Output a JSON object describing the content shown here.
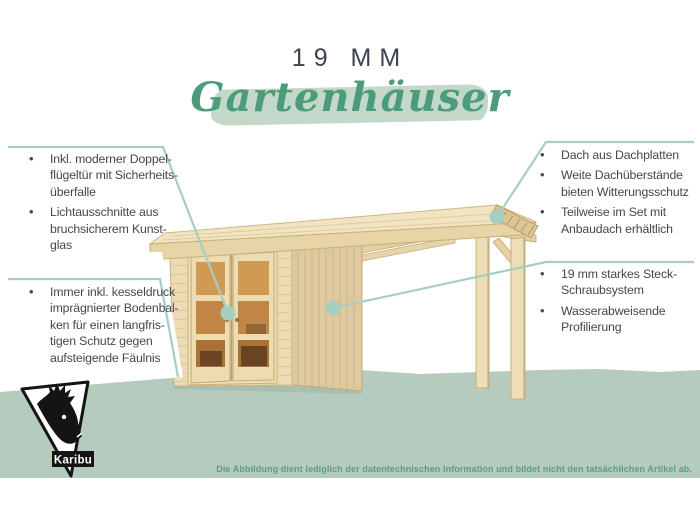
{
  "palette": {
    "accent_teal": "#a6cec1",
    "script_green": "#4c9c7c",
    "swash_green": "#c4d8ca",
    "ground_green": "#b5cbbd",
    "disclaimer_green": "#5aa07c",
    "heading_dark": "#3d4350",
    "text_dark": "#42484f",
    "wood_front": "#ecdbb3",
    "wood_side": "#dfc99e",
    "wood_roof_top": "#f2e4c0",
    "wood_fascia": "#e7d5a8",
    "wood_post": "#eedeb8",
    "wood_beam": "#e4d0a2",
    "logo_black": "#141414"
  },
  "header": {
    "size_label": "19 MM",
    "script_title": "Gartenhäuser"
  },
  "callouts": {
    "left_top": {
      "items": [
        "Inkl. moderner Doppel-\nflügeltür mit Sicherheits-\nüberfalle",
        "Lichtausschnitte aus\nbruchsicherem Kunst-\nglas"
      ]
    },
    "left_bottom": {
      "items": [
        "Immer inkl. kesseldruck\nimprägnierter Bodenbal-\nken für einen langfris-\ntigen Schutz gegen\naufsteigende Fäulnis"
      ]
    },
    "right_top": {
      "items": [
        "Dach aus Dachplatten",
        "Weite Dachüberstände\nbieten Witterungsschutz",
        "Teilweise im Set mit\nAnbaudach erhältlich"
      ]
    },
    "right_bottom": {
      "items": [
        "19 mm starkes Steck-\nSchraubsystem",
        "Wasserabweisende\nProfilierung"
      ]
    }
  },
  "bullet_glyph": "•",
  "logo": {
    "brand": "Karibu"
  },
  "footer": {
    "disclaimer": "Die Abbildung dient lediglich der datentechnischen Information und bildet nicht den tatsächlichen Artikel ab."
  }
}
